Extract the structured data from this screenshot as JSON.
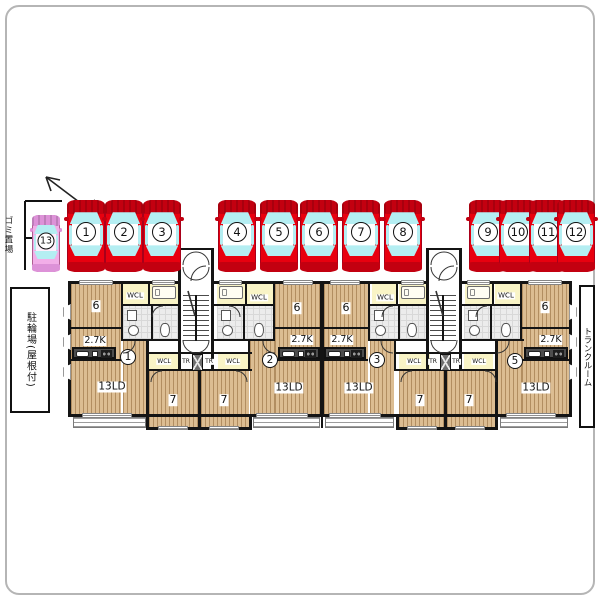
{
  "site": {
    "labels": {
      "garbage": "ゴミ置場",
      "bicycle": "駐輪場(屋根付)",
      "trunk": "トランクルーム"
    }
  },
  "parking": {
    "colors": {
      "red_body": "#e8000f",
      "red_dark": "#c30010",
      "pink_body": "#f2aee8",
      "pink_dark": "#dd92d8",
      "window": "#b4eef2",
      "roof": "#ffffff"
    },
    "red_size": {
      "w": 38,
      "h": 72,
      "top": 200
    },
    "pink_size": {
      "w": 28,
      "h": 57,
      "top": 215
    },
    "spaces": [
      {
        "n": "1",
        "cx": 86
      },
      {
        "n": "2",
        "cx": 124
      },
      {
        "n": "3",
        "cx": 162
      },
      {
        "n": "4",
        "cx": 237
      },
      {
        "n": "5",
        "cx": 279
      },
      {
        "n": "6",
        "cx": 319
      },
      {
        "n": "7",
        "cx": 361
      },
      {
        "n": "8",
        "cx": 403
      },
      {
        "n": "9",
        "cx": 488
      },
      {
        "n": "10",
        "cx": 518
      },
      {
        "n": "11",
        "cx": 548
      },
      {
        "n": "12",
        "cx": 576
      },
      {
        "n": "13",
        "cx": 46,
        "pink": true
      }
    ]
  },
  "floorplan": {
    "unit_markers": [
      {
        "n": "1",
        "x": 128,
        "y": 357
      },
      {
        "n": "2",
        "x": 270,
        "y": 360
      },
      {
        "n": "3",
        "x": 377,
        "y": 360
      },
      {
        "n": "5",
        "x": 515,
        "y": 361
      }
    ],
    "room_labels": [
      {
        "t": "6",
        "x": 96,
        "y": 306,
        "s": 11
      },
      {
        "t": "6",
        "x": 297,
        "y": 308,
        "s": 11
      },
      {
        "t": "6",
        "x": 346,
        "y": 308,
        "s": 11
      },
      {
        "t": "6",
        "x": 545,
        "y": 307,
        "s": 11
      },
      {
        "t": "2.7K",
        "x": 95,
        "y": 341,
        "s": 9.5
      },
      {
        "t": "2.7K",
        "x": 302,
        "y": 340,
        "s": 9.5
      },
      {
        "t": "2.7K",
        "x": 342,
        "y": 340,
        "s": 9.5
      },
      {
        "t": "2.7K",
        "x": 551,
        "y": 340,
        "s": 9.5
      },
      {
        "t": "13LD",
        "x": 112,
        "y": 387,
        "s": 10.5
      },
      {
        "t": "13LD",
        "x": 289,
        "y": 388,
        "s": 10.5
      },
      {
        "t": "13LD",
        "x": 359,
        "y": 388,
        "s": 10.5
      },
      {
        "t": "13LD",
        "x": 536,
        "y": 388,
        "s": 10.5
      },
      {
        "t": "7",
        "x": 173,
        "y": 400,
        "s": 11
      },
      {
        "t": "7",
        "x": 224,
        "y": 400,
        "s": 11
      },
      {
        "t": "7",
        "x": 420,
        "y": 400,
        "s": 11
      },
      {
        "t": "7",
        "x": 469,
        "y": 400,
        "s": 11
      },
      {
        "t": "WCL",
        "x": 135,
        "y": 296,
        "s": 7
      },
      {
        "t": "WCL",
        "x": 259,
        "y": 298,
        "s": 7
      },
      {
        "t": "WCL",
        "x": 385,
        "y": 298,
        "s": 7
      },
      {
        "t": "WCL",
        "x": 506,
        "y": 296,
        "s": 7
      },
      {
        "t": "WCL",
        "x": 164,
        "y": 362,
        "s": 6
      },
      {
        "t": "WCL",
        "x": 233,
        "y": 362,
        "s": 6
      },
      {
        "t": "WCL",
        "x": 414,
        "y": 362,
        "s": 6
      },
      {
        "t": "WCL",
        "x": 479,
        "y": 362,
        "s": 6
      },
      {
        "t": "TR",
        "x": 186,
        "y": 362,
        "s": 6
      },
      {
        "t": "TR",
        "x": 209,
        "y": 362,
        "s": 6
      },
      {
        "t": "TR",
        "x": 433,
        "y": 362,
        "s": 6
      },
      {
        "t": "TR",
        "x": 456,
        "y": 362,
        "s": 6
      }
    ],
    "geometry": {
      "rooms": [
        {
          "c": "wood",
          "r": [
            71,
            284,
            50,
            44
          ]
        },
        {
          "c": "wood",
          "r": [
            275,
            284,
            45,
            44
          ]
        },
        {
          "c": "wood",
          "r": [
            324,
            284,
            44,
            44
          ]
        },
        {
          "c": "wood",
          "r": [
            522,
            284,
            47,
            44
          ]
        },
        {
          "c": "wood",
          "r": [
            71,
            329,
            50,
            86
          ]
        },
        {
          "c": "wood",
          "r": [
            123,
            341,
            23,
            74
          ]
        },
        {
          "c": "wood",
          "r": [
            275,
            329,
            45,
            86
          ]
        },
        {
          "c": "wood",
          "r": [
            250,
            341,
            25,
            74
          ]
        },
        {
          "c": "wood",
          "r": [
            324,
            329,
            44,
            86
          ]
        },
        {
          "c": "wood",
          "r": [
            370,
            341,
            24,
            74
          ]
        },
        {
          "c": "wood",
          "r": [
            522,
            329,
            47,
            86
          ]
        },
        {
          "c": "wood",
          "r": [
            497,
            341,
            25,
            74
          ]
        },
        {
          "c": "wood",
          "r": [
            149,
            371,
            49,
            57
          ]
        },
        {
          "c": "wood",
          "r": [
            201,
            371,
            48,
            57
          ]
        },
        {
          "c": "wood",
          "r": [
            399,
            371,
            45,
            57
          ]
        },
        {
          "c": "wood",
          "r": [
            447,
            371,
            48,
            57
          ]
        },
        {
          "c": "yellow",
          "r": [
            123,
            284,
            25,
            21
          ]
        },
        {
          "c": "yellow",
          "r": [
            247,
            284,
            26,
            21
          ]
        },
        {
          "c": "yellow",
          "r": [
            372,
            284,
            24,
            21
          ]
        },
        {
          "c": "yellow",
          "r": [
            495,
            284,
            25,
            21
          ]
        },
        {
          "c": "yellow",
          "r": [
            150,
            284,
            28,
            21
          ]
        },
        {
          "c": "yellow",
          "r": [
            217,
            284,
            28,
            21
          ]
        },
        {
          "c": "yellow",
          "r": [
            399,
            284,
            28,
            21
          ]
        },
        {
          "c": "yellow",
          "r": [
            465,
            284,
            27,
            21
          ]
        },
        {
          "c": "yellow",
          "r": [
            149,
            354,
            31,
            15
          ]
        },
        {
          "c": "yellow",
          "r": [
            218,
            354,
            30,
            15
          ]
        },
        {
          "c": "yellow",
          "r": [
            399,
            354,
            31,
            15
          ]
        },
        {
          "c": "yellow",
          "r": [
            464,
            354,
            29,
            15
          ]
        },
        {
          "c": "bath",
          "r": [
            123,
            306,
            57,
            33
          ]
        },
        {
          "c": "bath",
          "r": [
            217,
            306,
            56,
            33
          ]
        },
        {
          "c": "bath",
          "r": [
            370,
            306,
            57,
            33
          ]
        },
        {
          "c": "bath",
          "r": [
            464,
            306,
            56,
            33
          ]
        },
        {
          "c": "stairs",
          "r": [
            183,
            295,
            26,
            46
          ]
        },
        {
          "c": "stairs",
          "r": [
            430,
            295,
            26,
            46
          ]
        },
        {
          "c": "balcony",
          "r": [
            73,
            417,
            73,
            11
          ]
        },
        {
          "c": "balcony",
          "r": [
            253,
            417,
            67,
            11
          ]
        },
        {
          "c": "balcony",
          "r": [
            325,
            417,
            69,
            11
          ]
        },
        {
          "c": "balcony",
          "r": [
            500,
            417,
            68,
            11
          ]
        }
      ],
      "walls": [
        [
          68,
          281,
          112,
          3
        ],
        [
          214,
          281,
          212,
          3
        ],
        [
          462,
          281,
          110,
          3
        ],
        [
          68,
          281,
          3,
          136
        ],
        [
          569,
          281,
          3,
          136
        ],
        [
          68,
          414,
          504,
          3
        ],
        [
          146,
          414,
          3,
          16
        ],
        [
          249,
          414,
          3,
          16
        ],
        [
          146,
          427,
          106,
          3
        ],
        [
          396,
          414,
          3,
          16
        ],
        [
          495,
          414,
          3,
          16
        ],
        [
          396,
          427,
          102,
          3
        ],
        [
          198,
          371,
          3,
          57
        ],
        [
          444,
          371,
          3,
          57
        ],
        [
          178,
          248,
          3,
          36
        ],
        [
          211,
          248,
          3,
          36
        ],
        [
          426,
          248,
          3,
          36
        ],
        [
          459,
          248,
          3,
          36
        ],
        [
          178,
          248,
          36,
          2
        ],
        [
          426,
          248,
          36,
          2
        ],
        [
          178,
          284,
          3,
          87
        ],
        [
          211,
          284,
          3,
          87
        ],
        [
          426,
          284,
          3,
          87
        ],
        [
          459,
          284,
          3,
          87
        ],
        [
          121,
          283,
          2,
          57
        ],
        [
          148,
          283,
          2,
          22
        ],
        [
          146,
          340,
          3,
          75
        ],
        [
          245,
          283,
          2,
          22
        ],
        [
          273,
          283,
          2,
          57
        ],
        [
          248,
          340,
          2,
          31
        ],
        [
          320,
          283,
          4,
          132
        ],
        [
          368,
          283,
          2,
          57
        ],
        [
          396,
          283,
          2,
          22
        ],
        [
          394,
          340,
          2,
          31
        ],
        [
          492,
          283,
          2,
          22
        ],
        [
          520,
          283,
          2,
          57
        ],
        [
          495,
          340,
          3,
          75
        ],
        [
          71,
          327,
          50,
          2
        ],
        [
          275,
          327,
          45,
          2
        ],
        [
          324,
          327,
          44,
          2
        ],
        [
          522,
          327,
          47,
          2
        ],
        [
          121,
          304,
          59,
          2
        ],
        [
          214,
          304,
          61,
          2
        ],
        [
          368,
          304,
          60,
          2
        ],
        [
          462,
          304,
          60,
          2
        ],
        [
          121,
          339,
          59,
          2
        ],
        [
          214,
          339,
          61,
          2
        ],
        [
          368,
          339,
          60,
          2
        ],
        [
          462,
          339,
          60,
          2
        ],
        [
          248,
          339,
          27,
          2
        ],
        [
          495,
          339,
          29,
          2
        ],
        [
          146,
          352,
          106,
          2
        ],
        [
          396,
          352,
          101,
          2
        ],
        [
          146,
          369,
          106,
          2
        ],
        [
          396,
          369,
          101,
          2
        ],
        [
          71,
          359,
          50,
          2
        ],
        [
          275,
          359,
          45,
          2
        ],
        [
          324,
          359,
          44,
          2
        ],
        [
          522,
          359,
          47,
          2
        ],
        [
          151,
          306,
          2,
          33
        ],
        [
          243,
          306,
          2,
          33
        ],
        [
          398,
          306,
          2,
          33
        ],
        [
          490,
          306,
          2,
          33
        ],
        [
          195,
          295,
          2,
          46
        ],
        [
          442,
          295,
          2,
          46
        ],
        [
          321,
          416,
          2,
          12
        ]
      ],
      "windows": [
        [
          79,
          280,
          34,
          5
        ],
        [
          152,
          280,
          23,
          5
        ],
        [
          219,
          280,
          23,
          5
        ],
        [
          283,
          280,
          30,
          5
        ],
        [
          330,
          280,
          30,
          5
        ],
        [
          401,
          280,
          23,
          5
        ],
        [
          467,
          280,
          23,
          5
        ],
        [
          528,
          280,
          34,
          5
        ],
        [
          82,
          413,
          50,
          5
        ],
        [
          256,
          413,
          52,
          5
        ],
        [
          329,
          413,
          52,
          5
        ],
        [
          506,
          413,
          50,
          5
        ],
        [
          158,
          426,
          30,
          4
        ],
        [
          209,
          426,
          30,
          4
        ],
        [
          407,
          426,
          30,
          4
        ],
        [
          455,
          426,
          30,
          4
        ]
      ],
      "bays_left": [
        [
          63,
          304,
          8,
          16
        ],
        [
          63,
          334,
          8,
          16
        ],
        [
          63,
          364,
          8,
          16
        ]
      ],
      "bays_right": [
        [
          569,
          304,
          8,
          16
        ],
        [
          569,
          334,
          8,
          16
        ],
        [
          569,
          364,
          8,
          16
        ]
      ],
      "beds": [
        [
          152,
          286,
          24,
          13
        ],
        [
          219,
          286,
          24,
          13
        ],
        [
          401,
          286,
          24,
          13
        ],
        [
          467,
          286,
          23,
          13
        ]
      ],
      "counters": [
        [
          72,
          347,
          44,
          12
        ],
        [
          278,
          347,
          42,
          12
        ],
        [
          324,
          347,
          42,
          12
        ],
        [
          524,
          347,
          44,
          12
        ]
      ],
      "xboxes": [
        [
          192,
          354,
          11,
          17
        ],
        [
          440,
          354,
          11,
          17
        ]
      ],
      "baths": [
        [
          123,
          306
        ],
        [
          217,
          306
        ],
        [
          370,
          306
        ],
        [
          464,
          306
        ]
      ]
    }
  }
}
